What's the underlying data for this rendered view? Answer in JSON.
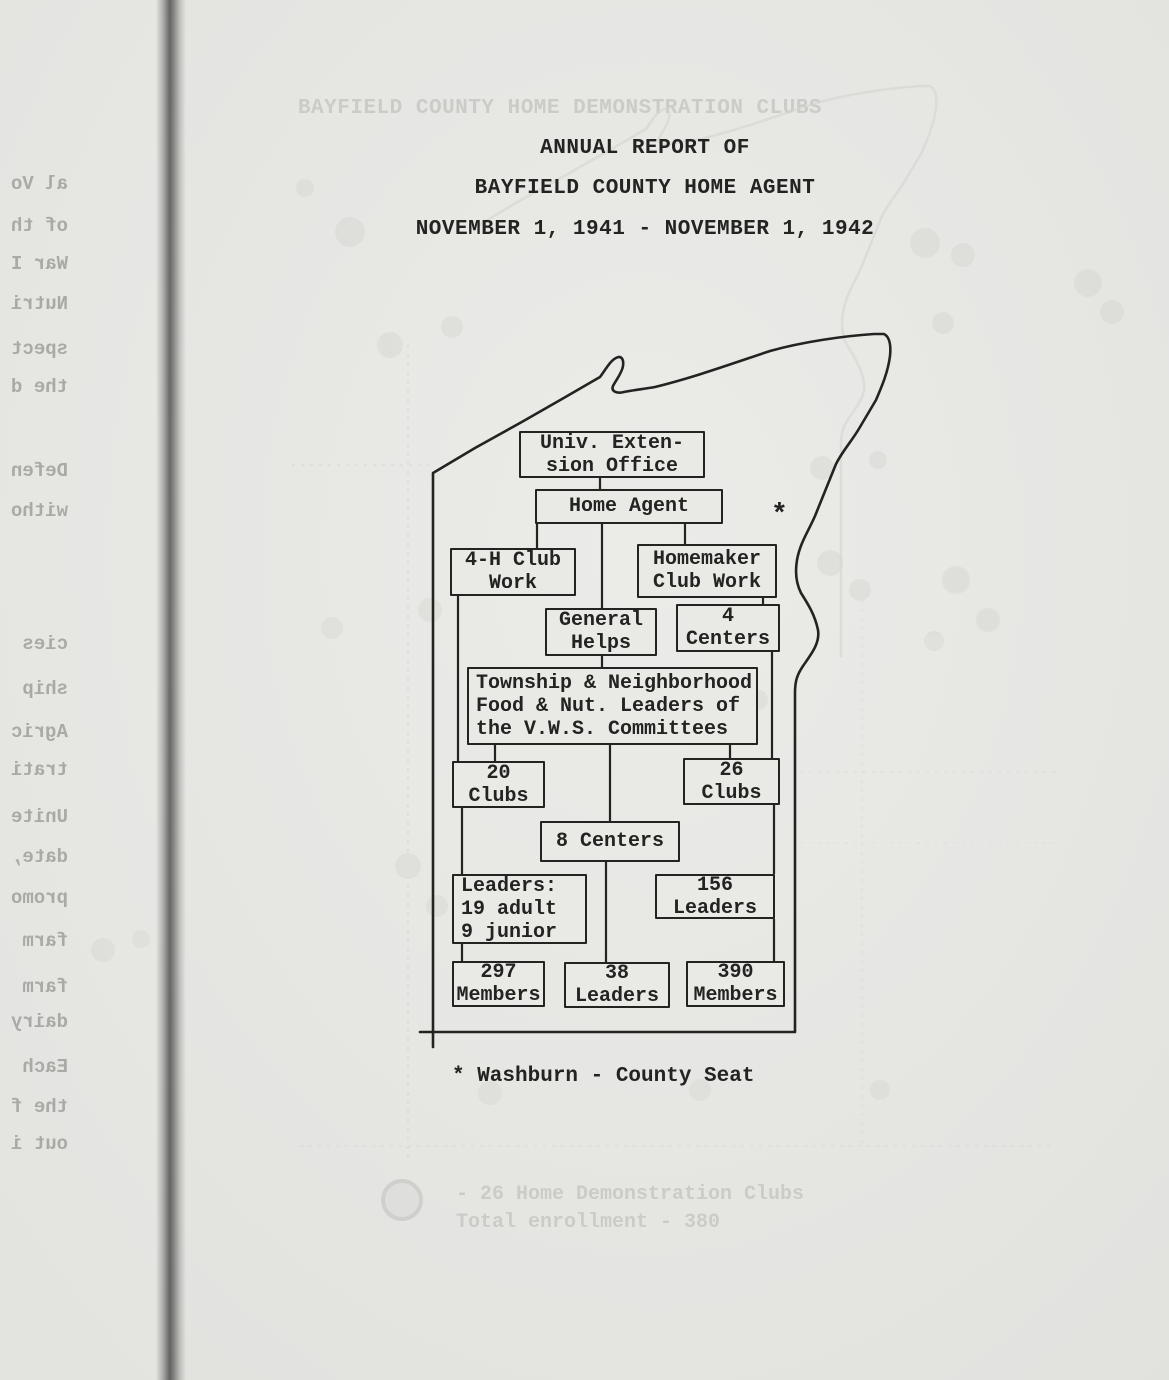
{
  "document": {
    "title_line1": "ANNUAL REPORT OF",
    "title_line2": "BAYFIELD COUNTY HOME AGENT",
    "title_line3": "NOVEMBER 1, 1941 - NOVEMBER 1, 1942",
    "footnote": "* Washburn - County Seat",
    "map_asterisk": "*"
  },
  "org_chart": {
    "nodes": [
      {
        "id": "univ-extension-office",
        "lines": [
          "Univ. Exten-",
          "sion Office"
        ]
      },
      {
        "id": "home-agent",
        "lines": [
          "Home Agent"
        ]
      },
      {
        "id": "four-h-club-work",
        "lines": [
          "4-H Club",
          "Work"
        ]
      },
      {
        "id": "homemaker-club-work",
        "lines": [
          "Homemaker",
          "Club Work"
        ]
      },
      {
        "id": "general-helps",
        "lines": [
          "General",
          "Helps"
        ]
      },
      {
        "id": "four-centers",
        "lines": [
          "4",
          "Centers"
        ]
      },
      {
        "id": "township-neighborhood-committee",
        "lines": [
          "Township & Neighborhood",
          "Food & Nut. Leaders of",
          "the V.W.S. Committees"
        ]
      },
      {
        "id": "twenty-clubs",
        "lines": [
          "20",
          "Clubs"
        ]
      },
      {
        "id": "twenty-six-clubs",
        "lines": [
          "26",
          "Clubs"
        ]
      },
      {
        "id": "eight-centers",
        "lines": [
          "8 Centers"
        ]
      },
      {
        "id": "four-h-leaders",
        "lines": [
          "Leaders:",
          "19 adult",
          "9 junior"
        ]
      },
      {
        "id": "one-fifty-six-leaders",
        "lines": [
          "156",
          "Leaders"
        ]
      },
      {
        "id": "two-ninety-seven-members",
        "lines": [
          "297",
          "Members"
        ]
      },
      {
        "id": "thirty-eight-leaders",
        "lines": [
          "38",
          "Leaders"
        ]
      },
      {
        "id": "three-ninety-members",
        "lines": [
          "390",
          "Members"
        ]
      }
    ]
  },
  "ghost_bleedthrough": {
    "header": "BAYFIELD COUNTY HOME DEMONSTRATION CLUBS",
    "legend_line1": "- 26 Home Demonstration Clubs",
    "legend_line2": "Total enrollment - 380",
    "left_margin_fragments": [
      "al Vo",
      "of th",
      "War I",
      "Nutri",
      "spect",
      "the d",
      "Defen",
      "witho",
      "cies",
      "ship",
      "Agric",
      "trati",
      "Unite",
      "date,",
      "promo",
      "farm",
      "farm",
      "dairy",
      "Each",
      "the f",
      "out i"
    ]
  },
  "colors": {
    "paper": "#e9e9e6",
    "ink": "#232321",
    "ghost": "#cbcbc7",
    "bleed_text": "#a9a9a6",
    "binding": "#646462"
  }
}
